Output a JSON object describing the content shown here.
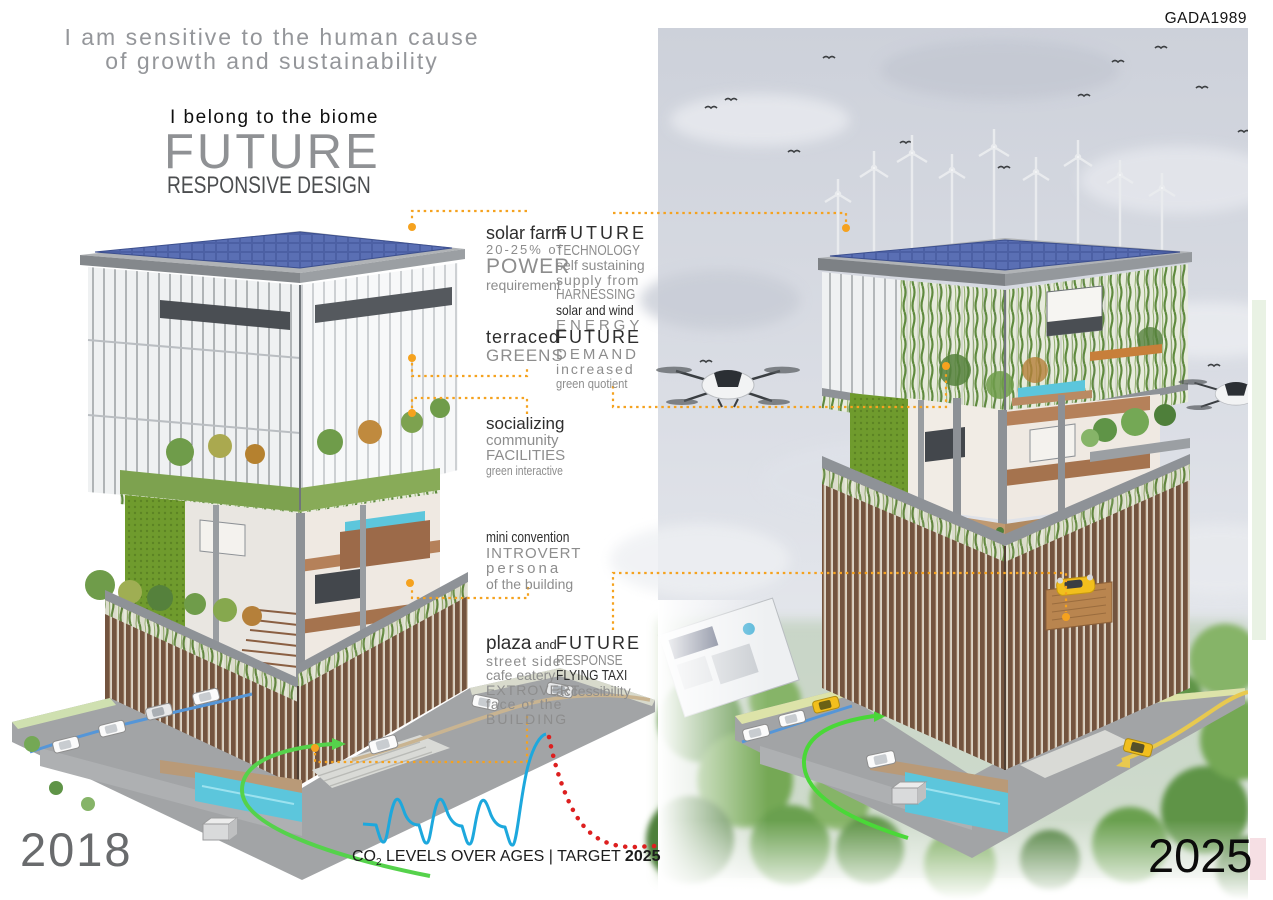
{
  "board": {
    "watermark": "GADA1989",
    "tagline_line1": "I am sensitive to the human cause",
    "tagline_line2": "of growth and sustainability",
    "intro": "I belong to the biome",
    "title": "FUTURE",
    "subtitle": "RESPONSIVE DESIGN"
  },
  "years": {
    "before": "2018",
    "after": "2025"
  },
  "annotations": {
    "solar_farm": {
      "feature": [
        "solar farm",
        "20-25% of",
        "POWER",
        "requirement"
      ],
      "future": [
        "FUTURE",
        "TECHNOLOGY",
        "self sustaining",
        "supply from",
        "HARNESSING",
        "solar and wind",
        "ENERGY"
      ]
    },
    "terraced": {
      "feature": [
        "terraced",
        "GREENS"
      ],
      "future": [
        "FUTURE",
        "DEMAND",
        "increased",
        "green quotient"
      ]
    },
    "socializing": {
      "feature": [
        "socializing",
        "community",
        "FACILITIES",
        "green interactive"
      ]
    },
    "mini_convention": {
      "feature": [
        "mini convention",
        "INTROVERT",
        "persona",
        "of the building"
      ]
    },
    "plaza": {
      "feature_word": "plaza",
      "feature_and": " and",
      "feature": [
        "street side",
        "cafe eatery",
        "EXTROVERT",
        "face of the",
        "BUILDING"
      ],
      "future": [
        "FUTURE",
        "RESPONSE",
        "FLYING TAXI",
        "accessibility"
      ]
    }
  },
  "chart": {
    "caption_pre": "CO",
    "caption_sub": "2",
    "caption_mid": " LEVELS OVER AGES | TARGET ",
    "caption_target": "2025",
    "blue_path": "M363,824 L376,825 C380,838 381,843 384,842 C388,840 389,812 395,801 C399,795 402,806 405,814 C409,823 414,825 419,825 C423,838 424,844 427,843 C431,841 432,813 438,801 C442,795 445,806 448,814 C452,823 457,826 462,826 C466,839 467,845 470,844 C474,842 475,814 481,802 C485,796 488,807 491,815 C495,824 500,827 505,827 C509,840 510,846 513,845 C517,842 520,800 527,770 C533,745 541,735 546,734",
    "red_path": "M549,737 C552,752 556,768 561,782 C566,796 572,810 579,820 C586,830 594,837 603,841 C612,845 622,847 632,847 C641,847 650,846 657,846"
  },
  "chart_data": {
    "type": "line",
    "title": "CO2 LEVELS OVER AGES | TARGET 2025",
    "xlabel": "ages (time)",
    "ylabel": "CO2 level (relative)",
    "grid": false,
    "legend_position": "none",
    "series": [
      {
        "name": "CO2 levels over ages (cyclic glacial pattern, solid blue)",
        "color": "#1da8dd",
        "style": "solid",
        "x": [
          0,
          1,
          2,
          3,
          4,
          5,
          6,
          7,
          8,
          9,
          10,
          11,
          12,
          13,
          14
        ],
        "y": [
          0.35,
          0.3,
          0.68,
          0.42,
          0.35,
          0.3,
          0.68,
          0.42,
          0.35,
          0.3,
          0.66,
          0.42,
          0.34,
          0.28,
          1.0
        ]
      },
      {
        "name": "projected decline to 2025 target (dotted red)",
        "color": "#dd1f1f",
        "style": "dotted",
        "x": [
          14,
          15,
          16,
          17,
          18,
          19,
          20,
          21
        ],
        "y": [
          1.0,
          0.72,
          0.48,
          0.3,
          0.18,
          0.12,
          0.1,
          0.1
        ]
      }
    ],
    "annotation": "Sharp modern CO2 peak followed by targeted decline toward 2025"
  },
  "colors": {
    "accent_orange": "#f5a21f",
    "chart_blue": "#1da8dd",
    "chart_red": "#dd1f1f",
    "solar_panel_blue": "#4c60a4",
    "vine_green": "#5f8a3e",
    "green_wall": "#6f9b2d",
    "louver_brown": "#73543f",
    "route_green": "#4ad838",
    "route_yellow": "#e8c94f",
    "route_blue": "#5596d8",
    "route_tan": "#c9b491",
    "pool_blue": "#5cc6dc",
    "text_gray": "#8d8d8d",
    "text_dark": "#2e2e2e"
  }
}
